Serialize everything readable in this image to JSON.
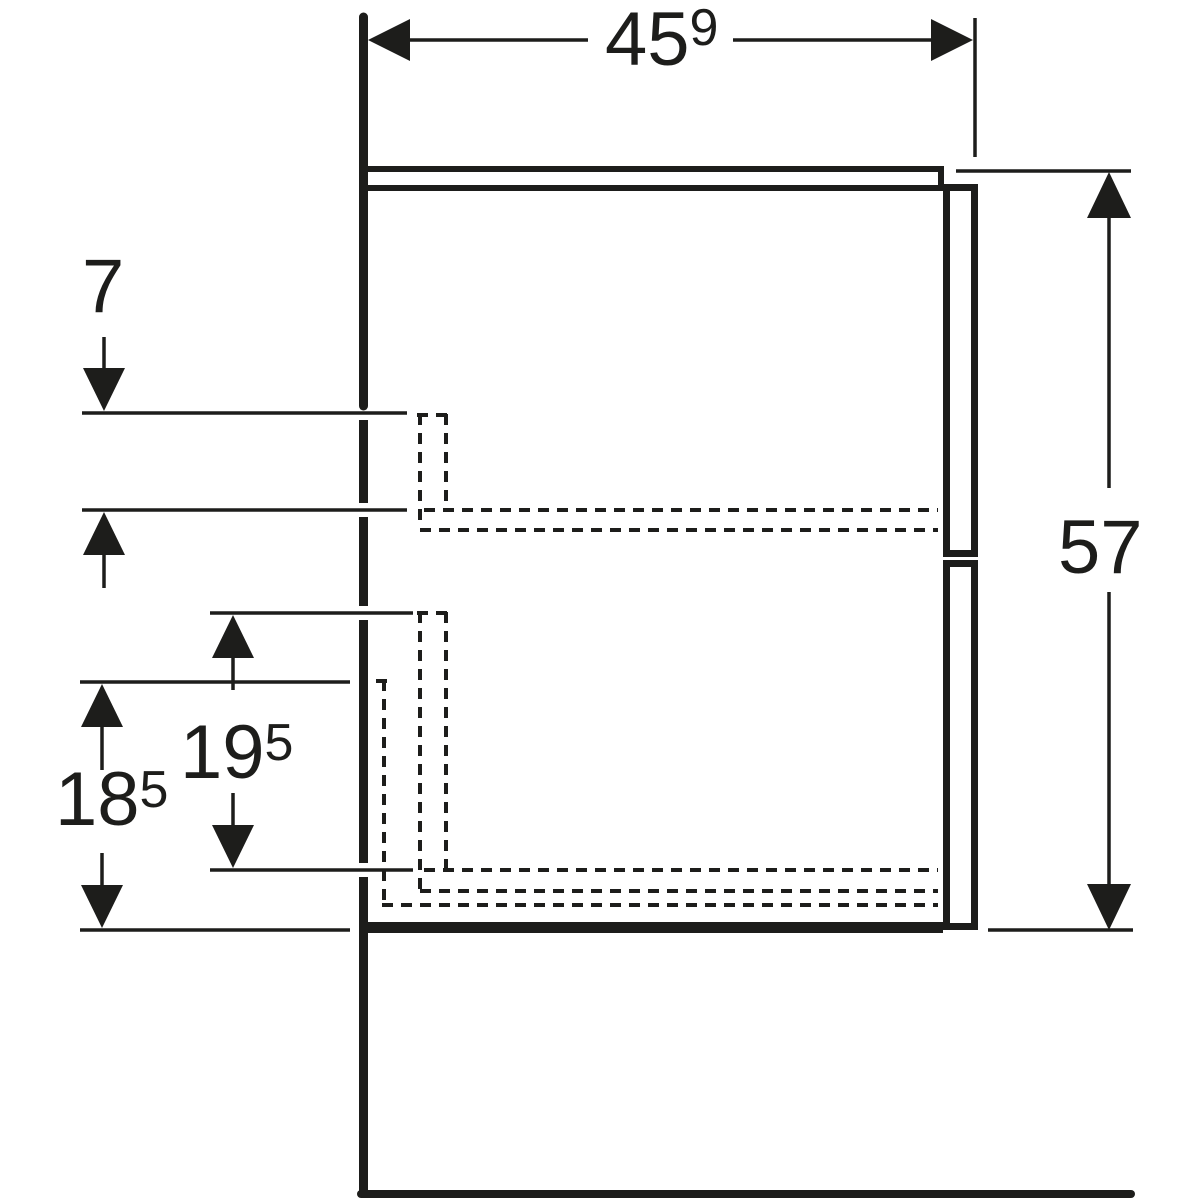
{
  "drawing": {
    "description": "Side-view technical dimension drawing of a wall-hung vanity cabinet with two drawers",
    "line_color": "#1d1d1b",
    "background_color": "#ffffff",
    "labels": {
      "depth": {
        "main": "45",
        "sup": "9"
      },
      "height": {
        "main": "57",
        "sup": ""
      },
      "top_offset": {
        "main": "7",
        "sup": ""
      },
      "inner_drawer_height": {
        "main": "19",
        "sup": "5"
      },
      "outer_drawer_height": {
        "main": "18",
        "sup": "5"
      }
    }
  }
}
